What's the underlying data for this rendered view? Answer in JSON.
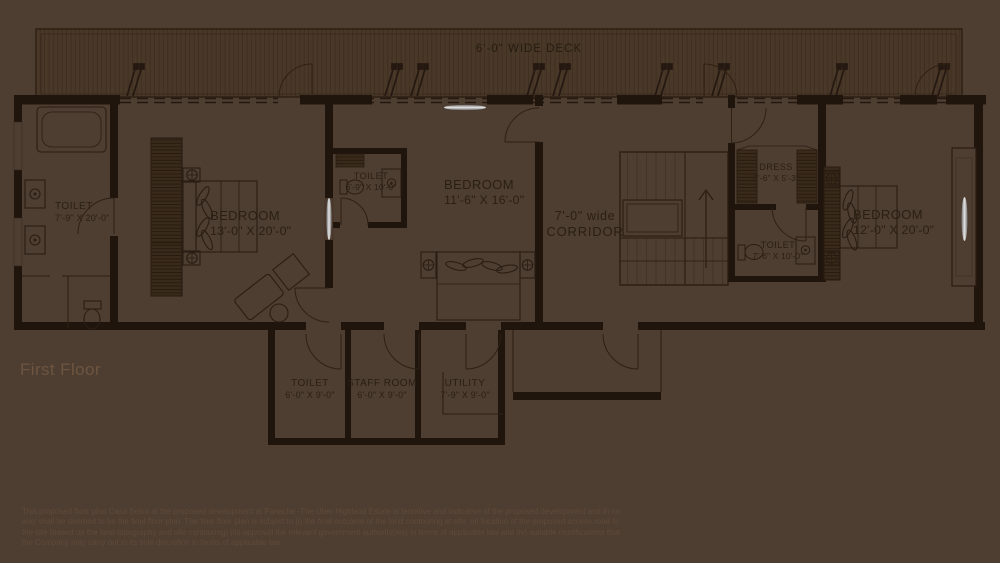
{
  "plan": {
    "title": "First Floor",
    "deck_label": "6'-0\" WIDE DECK",
    "rooms": [
      {
        "id": "toilet-left",
        "name": "TOILET",
        "size": "7'-9\" X 20'-0\""
      },
      {
        "id": "bedroom-left",
        "name": "BEDROOM",
        "size": "13'-0\" X 20'-0\""
      },
      {
        "id": "toilet-middle",
        "name": "TOILET",
        "size": "6'-9\" X 10'-0\""
      },
      {
        "id": "bedroom-middle",
        "name": "BEDROOM",
        "size": "11'-6\" X 16'-0\""
      },
      {
        "id": "corridor",
        "name": "7'-0\" wide",
        "size": "CORRIDOR"
      },
      {
        "id": "dress",
        "name": "DRESS",
        "size": "7'-6\" X 5'-3\""
      },
      {
        "id": "toilet-right",
        "name": "TOILET",
        "size": "7'-6\" X 10'-0\""
      },
      {
        "id": "bedroom-right",
        "name": "BEDROOM",
        "size": "12'-0\" X 20'-0\""
      },
      {
        "id": "toilet-bottom",
        "name": "TOILET",
        "size": "6'-0\" X 9'-0\""
      },
      {
        "id": "staff-room",
        "name": "STAFF ROOM",
        "size": "6'-0\" X 9'-0\""
      },
      {
        "id": "utility",
        "name": "UTILITY",
        "size": "7'-9\" X 9'-0\""
      }
    ],
    "disclaimer_lines": [
      "This proposed floor plan Casa Selva at the proposed development at Panache -The Uber Highland Estate is tentative and indicative of the proposed development and in no",
      "way shall be deemed to be the final floor plan. The final floor plan is  subject to (i) the final outcome of the land contouring at site; (ii) location of the proposed access road to",
      "the site (based on the land topography and site contouring) (iii) approval the relevant government authority(ies) in terms of applicable law and (iv) suitable modifications that",
      "the Company may carry out in its sole discretion in terms of applicable law."
    ],
    "colors": {
      "background": "#4e3d31",
      "wall": "#20150c",
      "line": "#2a1c10",
      "plan_text": "#2a1f13",
      "title_text": "#6d5540",
      "disclaimer_text": "#5f4b3a",
      "window_glass": "#d8d8d8"
    }
  }
}
